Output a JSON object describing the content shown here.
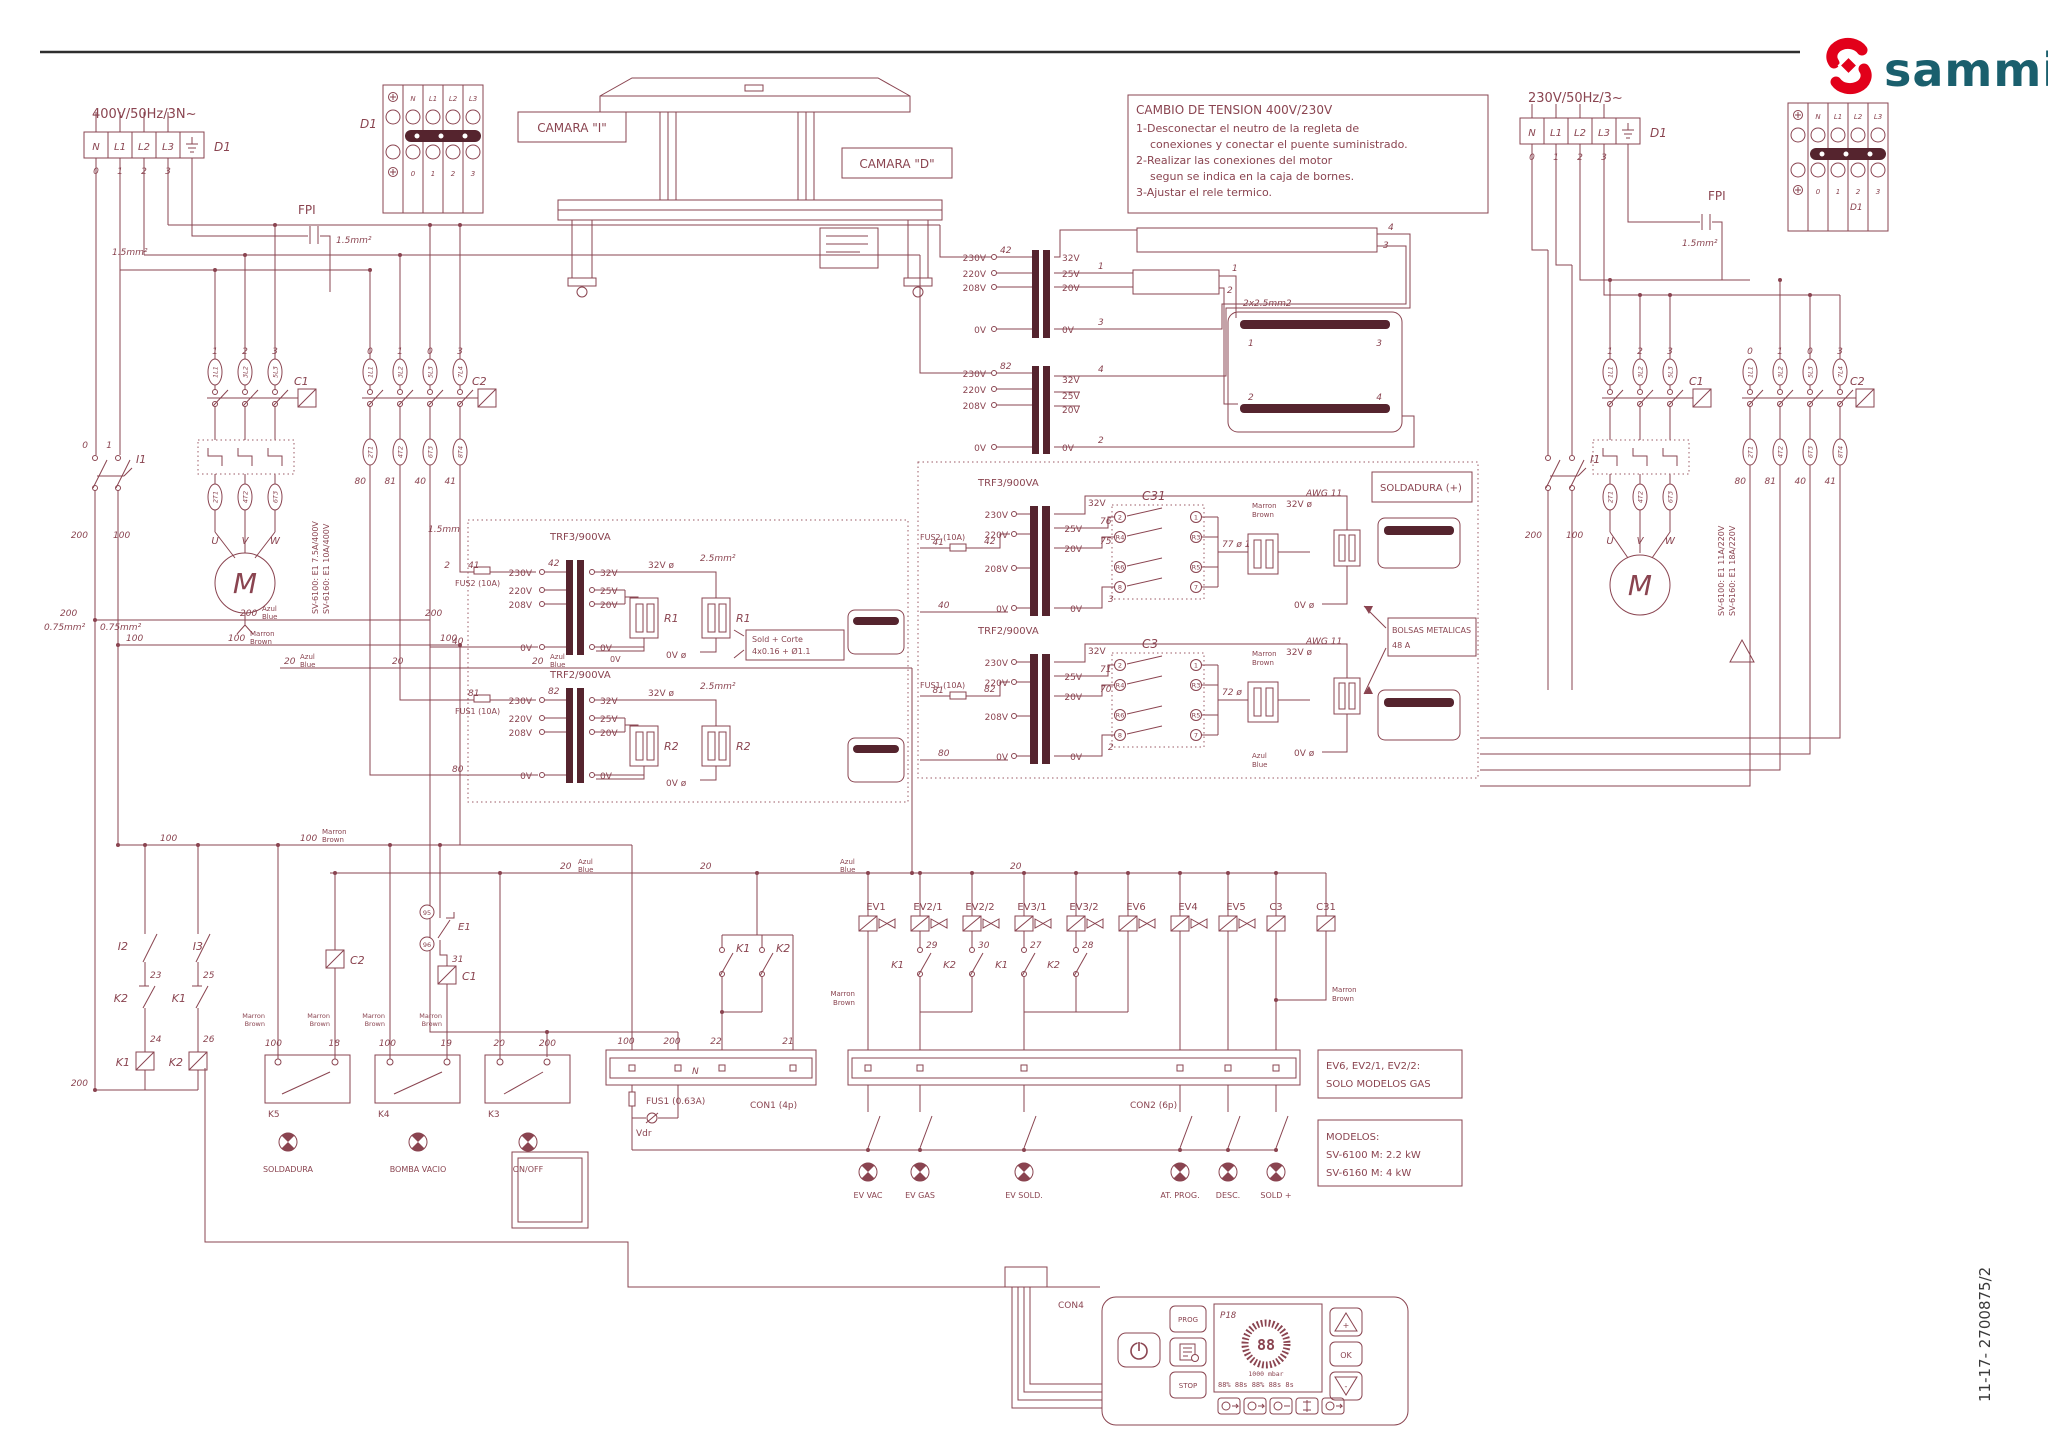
{
  "doc": {
    "num": "11-17- 2700875/2",
    "brand": "sammic"
  },
  "colors": {
    "line": "#8a4450",
    "dark": "#55242e",
    "brand_red": "#e2001a",
    "brand_teal": "#1a5f6d"
  },
  "supply": {
    "left": "400V/50Hz/3N~",
    "right": "230V/50Hz/3~",
    "n": "N",
    "l1": "L1",
    "l2": "L2",
    "l3": "L3",
    "d1": "D1",
    "fpi": "FPI"
  },
  "wire": {
    "0": "0",
    "1": "1",
    "2": "2",
    "3": "3",
    "4": "4",
    "18": "18",
    "19": "19",
    "20": "20",
    "21": "21",
    "22": "22",
    "23": "23",
    "24": "24",
    "25": "25",
    "26": "26",
    "27": "27",
    "28": "28",
    "29": "29",
    "30": "30",
    "31": "31",
    "40": "40",
    "41": "41",
    "42": "42",
    "70": "70",
    "71": "71",
    "72": "72 ø",
    "75": "75",
    "76": "76",
    "77": "77 ø 1",
    "80": "80",
    "81": "81",
    "82": "82",
    "95": "95",
    "96": "96",
    "100": "100",
    "200": "200"
  },
  "v": {
    "230": "230V",
    "220": "220V",
    "208": "208V",
    "32": "32V",
    "25": "25V",
    "20": "20V",
    "0": "0V",
    "32p": "32V ø",
    "0p": "0V ø"
  },
  "col": {
    "marron": "Marron",
    "brown": "Brown",
    "azul": "Azul",
    "blue": "Blue"
  },
  "mm": {
    "s075": "0.75mm²",
    "s15": "1.5mm²",
    "s15p": "1.5mm",
    "s25": "2.5mm²",
    "cable": "2x2.5mm2",
    "awg": "AWG 11"
  },
  "ct": {
    "c1": "C1",
    "c2": "C2",
    "i1": "I1",
    "t1": "1L1",
    "t2": "3L2",
    "t3": "5L3",
    "t4": "7L4",
    "b1": "2T1",
    "b2": "4T2",
    "b3": "6T3",
    "b4": "8T4",
    "u": "U",
    "v": "V",
    "w": "W",
    "m": "M"
  },
  "rele": {
    "left1": "SV-6100: E1 7.5A/400V",
    "left2": "SV-6160: E1 10A/400V",
    "right1": "SV-6100: E1 11A/220V",
    "right2": "SV-6160: E1 18A/220V"
  },
  "trf": {
    "t3": "TRF3/900VA",
    "t2": "TRF2/900VA",
    "fus1": "FUS1 (10A)",
    "fus2": "FUS2 (10A)",
    "r1": "R1",
    "r2": "R2"
  },
  "c31": {
    "label": "C31",
    "c3label": "C3",
    "p1": "1",
    "p2": "2",
    "p7": "7",
    "p8": "8",
    "r3": "R3",
    "r4": "R4",
    "r5": "R5",
    "r6": "R6"
  },
  "boxes": {
    "soldadura": "SOLDADURA (+)",
    "bolsas1": "BOLSAS METALICAS",
    "bolsas2": "48 A",
    "sold1": "Sold  +  Corte",
    "sold2": "4x0.16 +  Ø1.1",
    "gas1": "EV6, EV2/1, EV2/2:",
    "gas2": "SOLO MODELOS GAS",
    "mod1": "MODELOS:",
    "mod2": "SV-6100 M: 2.2 kW",
    "mod3": "SV-6160 M: 4 kW",
    "camara_i": "CAMARA \"I\"",
    "camara_d": "CAMARA \"D\""
  },
  "note": {
    "title": "CAMBIO DE TENSION 400V/230V",
    "l1": "1-Desconectar el neutro de la regleta de",
    "l2": "conexiones y conectar el puente suministrado.",
    "l3": "2-Realizar las conexiones del motor",
    "l4": "segun se indica en la caja de bornes.",
    "l5": "3-Ajustar el rele termico."
  },
  "relays": {
    "k1": "K1",
    "k2": "K2",
    "k3": "K3",
    "k4": "K4",
    "k5": "K5",
    "e1": "E1",
    "i2": "I2",
    "i3": "I3"
  },
  "con": {
    "con1": "CON1 (4p)",
    "con2": "CON2 (6p)",
    "con4": "CON4",
    "fus": "FUS1 (0.63A)",
    "vdr": "Vdr",
    "n": "N"
  },
  "ev": {
    "ev1": "EV1",
    "ev21": "EV2/1",
    "ev22": "EV2/2",
    "ev31": "EV3/1",
    "ev32": "EV3/2",
    "ev6": "EV6",
    "ev4": "EV4",
    "ev5": "EV5",
    "c3": "C3",
    "c31": "C31"
  },
  "out": {
    "vac": "EV VAC",
    "gas": "EV GAS",
    "sold": "EV SOLD.",
    "prog": "AT. PROG.",
    "desc": "DESC.",
    "soldp": "SOLD +"
  },
  "btn": {
    "soldadura": "SOLDADURA",
    "bomba": "BOMBA VACIO",
    "onoff": "ON/OFF"
  },
  "panel": {
    "prog": "PROG",
    "stop": "STOP",
    "ok": "OK",
    "disp": "P18",
    "digits": "88",
    "mbar": "1000 mbar",
    "row": "88%  88s  88%  88s  8s",
    "plus": "+",
    "minus": "-"
  }
}
